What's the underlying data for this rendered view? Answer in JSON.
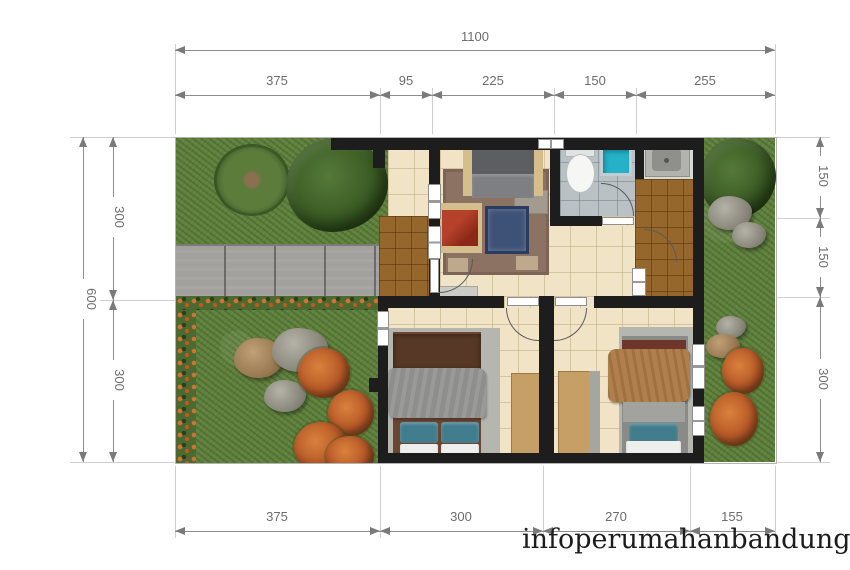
{
  "watermark": "infoperumahanbandung.com",
  "dimensions": {
    "top_total": "1100",
    "top_segments": [
      "375",
      "95",
      "225",
      "150",
      "255"
    ],
    "left_total": "600",
    "left_segments": [
      "300",
      "300"
    ],
    "right_segments": [
      "150",
      "150",
      "300"
    ],
    "bottom_segments": [
      "375",
      "300",
      "270",
      "155"
    ]
  },
  "palette": {
    "wall": "#1d1d1d",
    "floor_cream": "#f1e4c6",
    "floor_brown_tile": "#96672c",
    "floor_bath_gray": "#b9c1c5",
    "grass": "#61813f",
    "driveway": "#a2a19d",
    "shower_cyan": "#25b2c9",
    "pillow_teal": "#417d8d",
    "rug_brown": "#8c7262",
    "sofa_gray": "#5d5e61",
    "armchair_red": "#9c301e",
    "table_navy": "#3e5177",
    "dim_text": "#6c6c6c"
  }
}
